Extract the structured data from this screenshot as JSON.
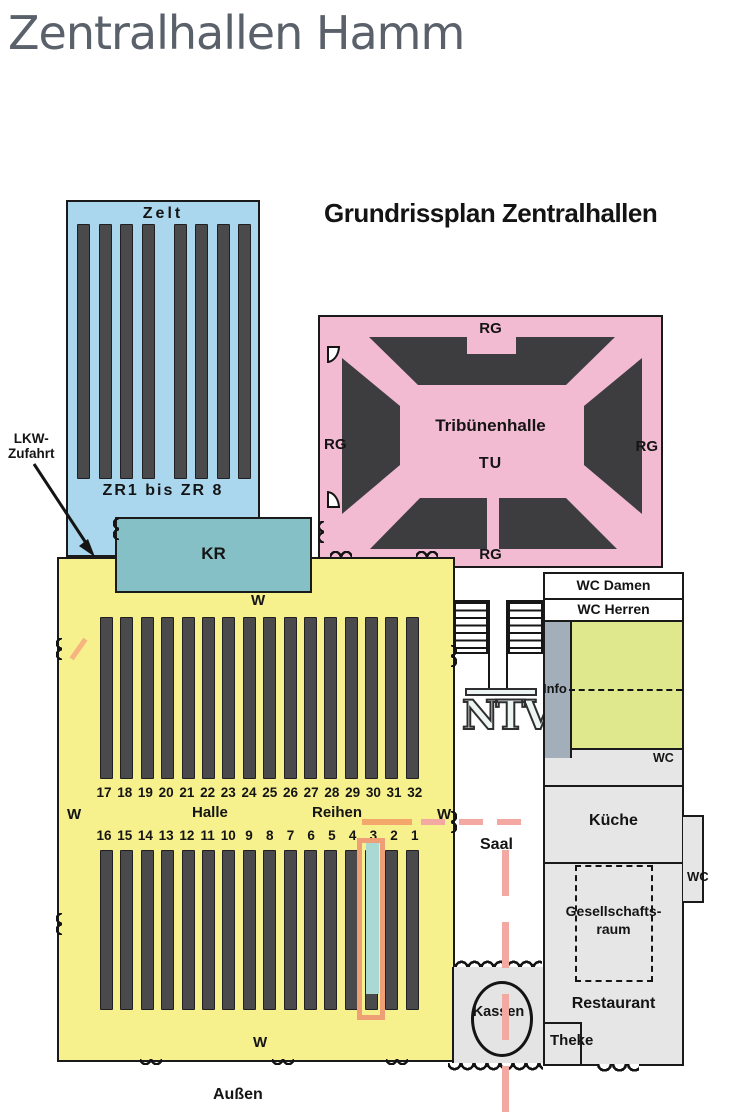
{
  "page": {
    "title": "Zentralhallen Hamm"
  },
  "plan": {
    "heading": "Grundrissplan Zentralhallen",
    "zelt": {
      "label": "Zelt",
      "range": "ZR1 bis ZR 8"
    },
    "lkw": {
      "line1": "LKW-",
      "line2": "Zufahrt"
    },
    "kr": {
      "label": "KR"
    },
    "tribuene": {
      "name": "Tribünenhalle",
      "code": "TU",
      "rg_top": "RG",
      "rg_left": "RG",
      "rg_right": "RG",
      "rg_bottom": "RG"
    },
    "halle": {
      "label": "Halle",
      "reihen": "Reihen",
      "w_top": "W",
      "w_left": "W",
      "w_right": "W",
      "w_bottom": "W",
      "top_numbers": [
        "17",
        "18",
        "19",
        "20",
        "21",
        "22",
        "23",
        "24",
        "25",
        "26",
        "27",
        "28",
        "29",
        "30",
        "31",
        "32"
      ],
      "bottom_numbers": [
        "16",
        "15",
        "14",
        "13",
        "12",
        "11",
        "10",
        "9",
        "8",
        "7",
        "6",
        "5",
        "4",
        "3",
        "2",
        "1"
      ],
      "highlighted_row": "3"
    },
    "saal": {
      "logo": "NTV",
      "label": "Saal"
    },
    "rooms": {
      "wc_damen": "WC Damen",
      "wc_herren": "WC Herren",
      "info": "Info",
      "wc_mid": "WC",
      "kueche": "Küche",
      "wc_right": "WC",
      "gesellschaft_line1": "Gesellschafts-",
      "gesellschaft_line2": "raum",
      "restaurant": "Restaurant",
      "theke": "Theke",
      "kassen": "Kassen"
    },
    "outside_label": "Außen",
    "colors": {
      "zelt": "#abd7ee",
      "kr": "#85c0c7",
      "tribuene": "#f2bbd1",
      "tribune_stands": "#3d3d40",
      "halle": "#f6f08d",
      "row_bars": "#4a4a4d",
      "highlight_row": "#aad9d3",
      "highlight_outline": "#ef9f76",
      "marker_red": "#f4a8a2",
      "marker_orange": "#f3a76b",
      "green_room": "#e0e88e",
      "info_strip": "#a2aeba",
      "gray_rooms": "#e6e6e7"
    }
  }
}
